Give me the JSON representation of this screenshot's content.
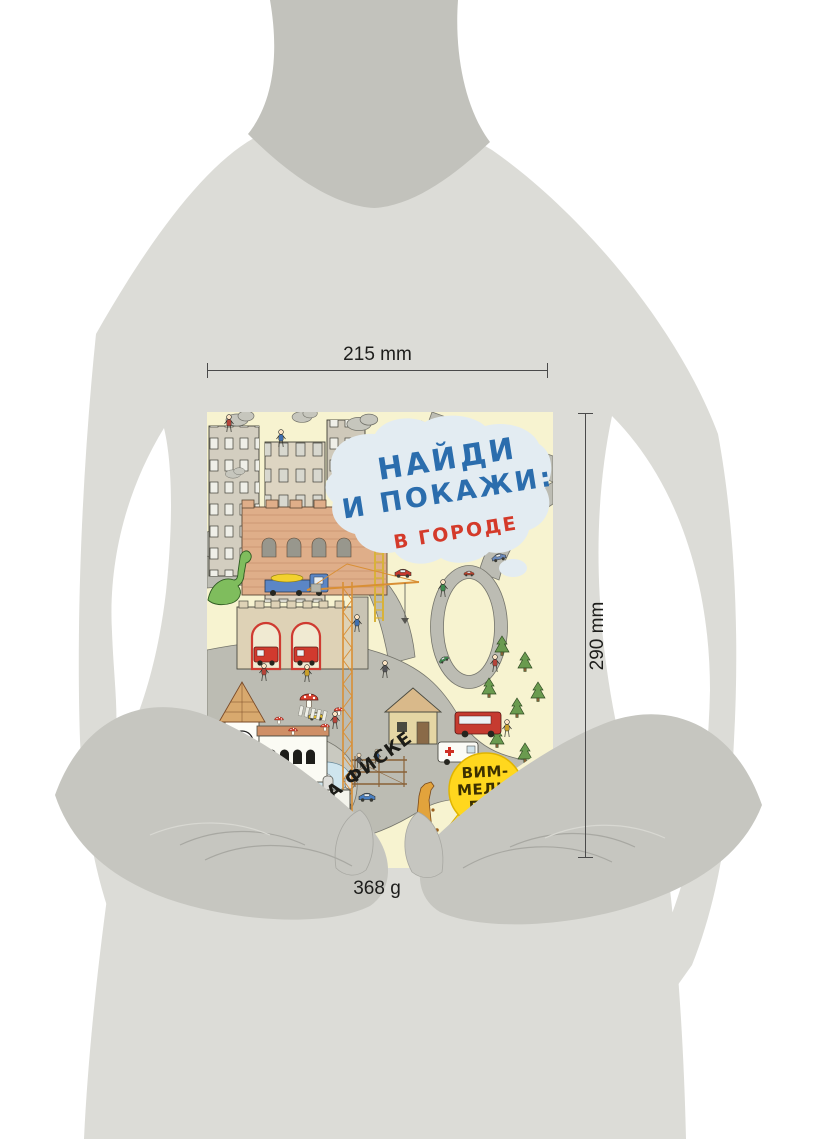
{
  "annotations": {
    "width": "215 mm",
    "height": "290 mm",
    "weight": "368 g"
  },
  "cover": {
    "title_line1": "НАЙДИ",
    "title_line2": "И ПОКАЖИ:",
    "subtitle": "В ГОРОДЕ",
    "author": "АННА ФИСКЕ",
    "badge_line1": "ВИМ-",
    "badge_line2": "МЕЛЬ-",
    "badge_line3": "БУХ",
    "publisher_mark": "махаон",
    "colors": {
      "cover_background": "#f7f3d0",
      "title_blue": "#2b6dad",
      "subtitle_red": "#d43a2a",
      "badge_yellow": "#ffd71e",
      "cloud_blue": "#e3ecf2",
      "road_gray": "#bcbcb3"
    }
  },
  "figure": {
    "body_light": "#dcdcd7",
    "neck_shade": "#c2c2bc",
    "hands_shade": "#c6c6c0"
  }
}
